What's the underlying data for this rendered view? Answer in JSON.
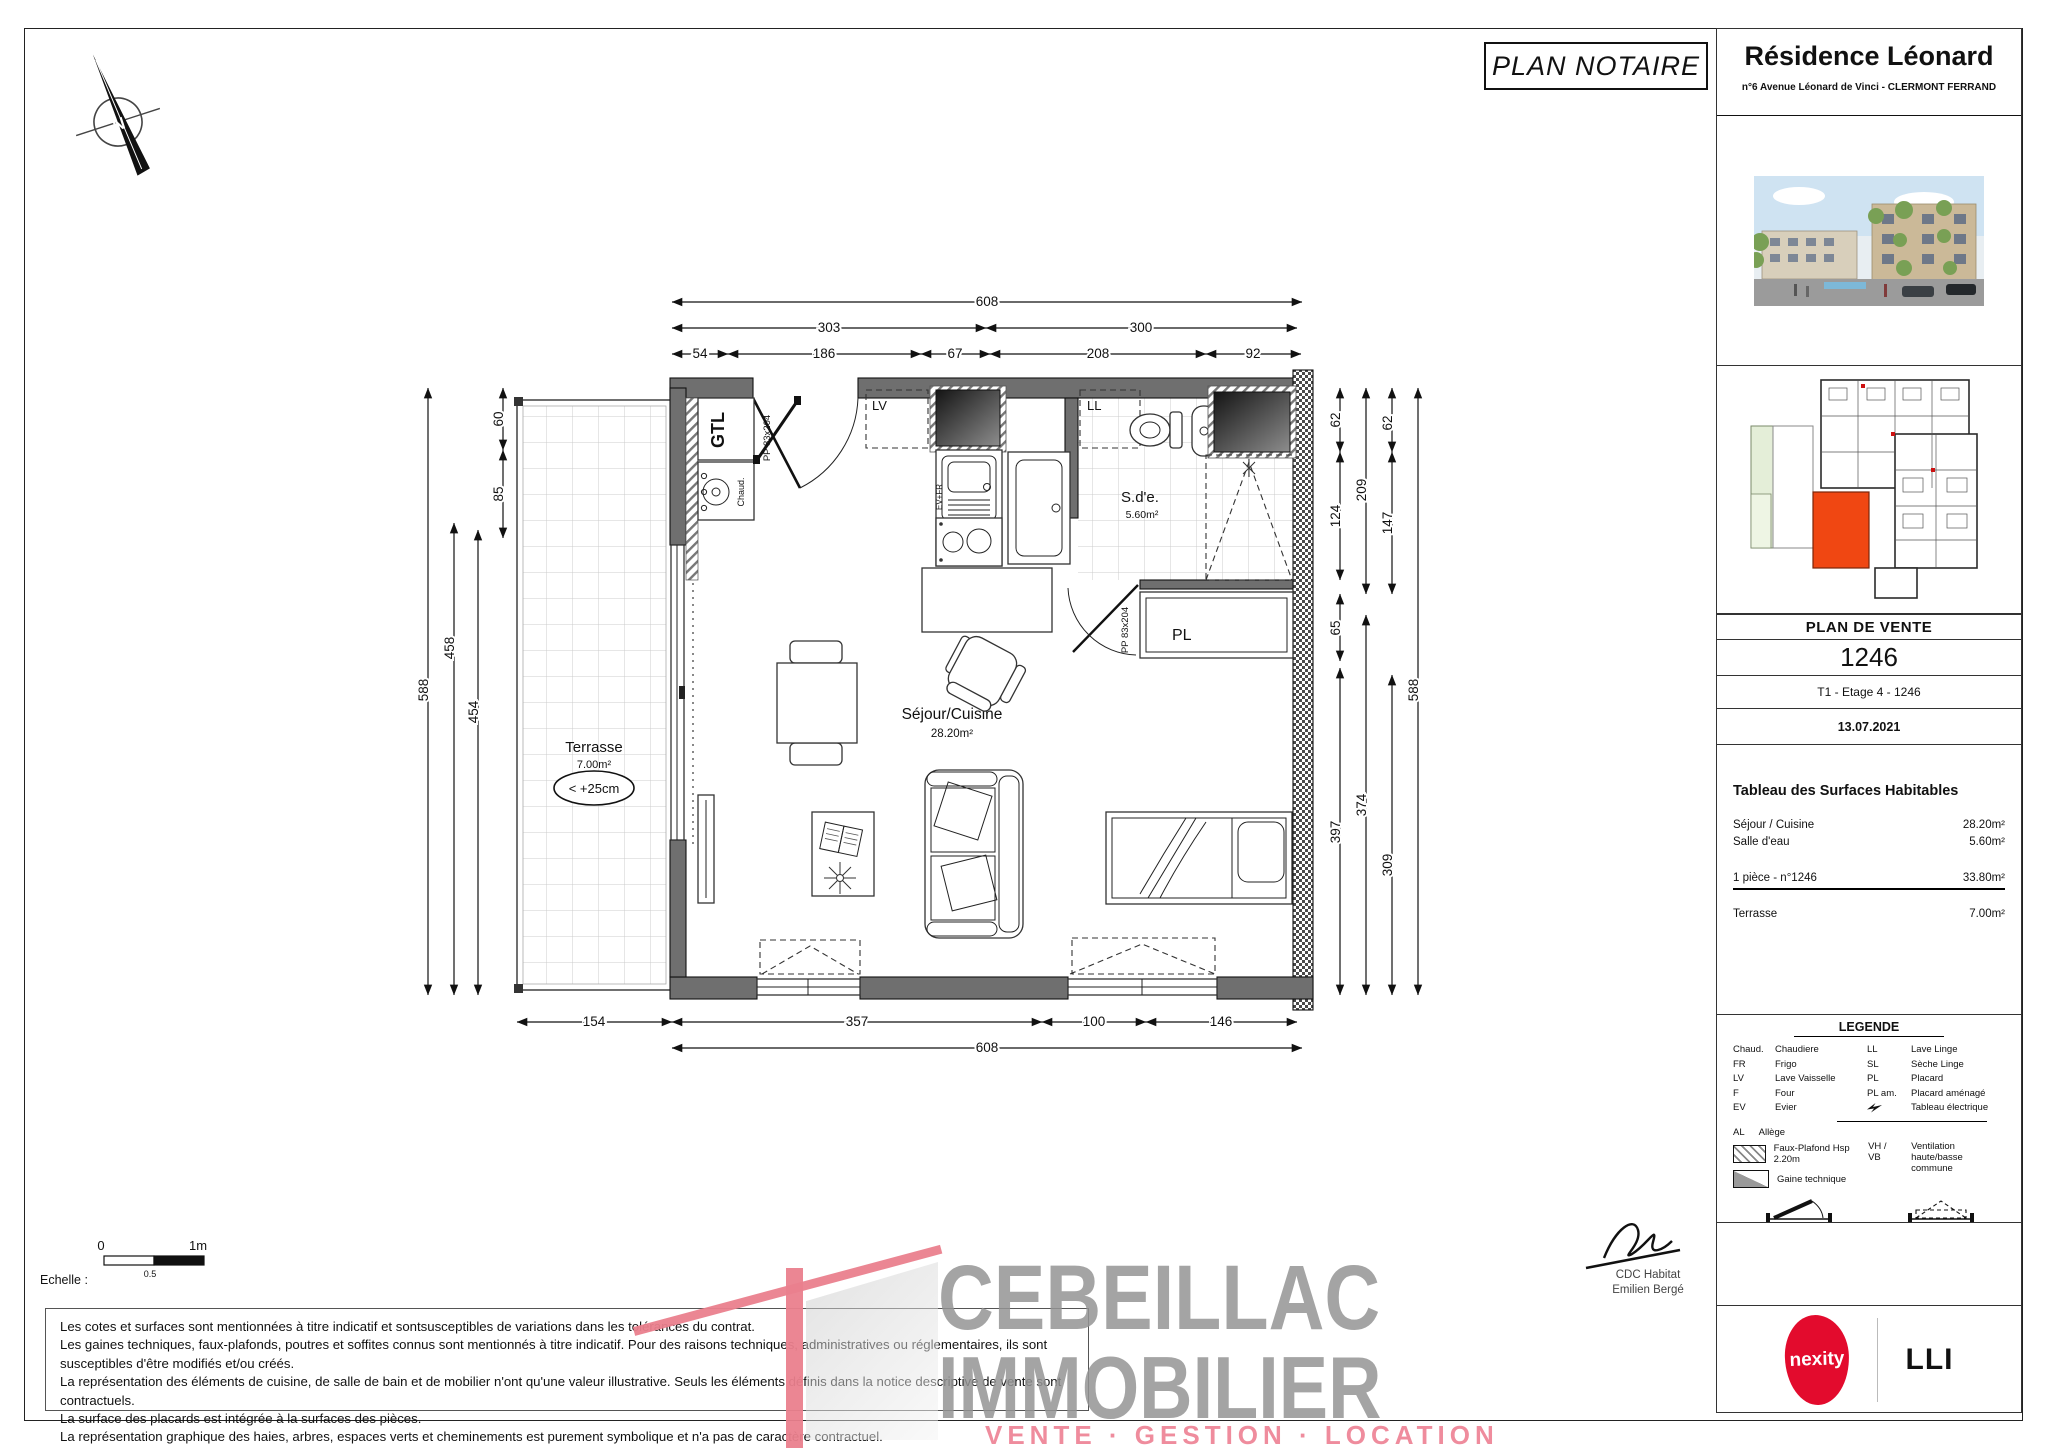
{
  "page": {
    "plan_notaire": "PLAN NOTAIRE",
    "echelle_label": "Echelle :",
    "scale_0": "0",
    "scale_05": "0.5",
    "scale_1m": "1m"
  },
  "header": {
    "title": "Résidence Léonard",
    "address": "n°6 Avenue Léonard de Vinci - CLERMONT FERRAND"
  },
  "sale": {
    "plan_de_vente": "PLAN DE VENTE",
    "lot_number": "1246",
    "lot_type": "T1 - Etage 4 - 1246",
    "date": "13.07.2021"
  },
  "surfaces": {
    "title": "Tableau des Surfaces Habitables",
    "rows": [
      {
        "label": "Séjour / Cuisine",
        "value": "28.20m²"
      },
      {
        "label": "Salle d'eau",
        "value": "5.60m²"
      }
    ],
    "total_label": "1 pièce - n°1246",
    "total_value": "33.80m²",
    "terrace_label": "Terrasse",
    "terrace_value": "7.00m²"
  },
  "legend": {
    "title": "LEGENDE",
    "col1": [
      {
        "abbr": "Chaud.",
        "label": "Chaudiere"
      },
      {
        "abbr": "FR",
        "label": "Frigo"
      },
      {
        "abbr": "LV",
        "label": "Lave Vaisselle"
      },
      {
        "abbr": "F",
        "label": "Four"
      },
      {
        "abbr": "EV",
        "label": "Evier"
      }
    ],
    "col2": [
      {
        "abbr": "LL",
        "label": "Lave Linge"
      },
      {
        "abbr": "SL",
        "label": "Sèche Linge"
      },
      {
        "abbr": "PL",
        "label": "Placard"
      },
      {
        "abbr": "PL am.",
        "label": "Placard aménagé"
      },
      {
        "abbr": "",
        "label": "Tableau électrique"
      }
    ],
    "al_abbr": "AL",
    "al_label": "Allège",
    "faux_plafond": "Faux-Plafond Hsp 2.20m",
    "gaine": "Gaine technique",
    "vh_abbr": "VH / VB",
    "vh_label1": "Ventilation",
    "vh_label2": "haute/basse commune",
    "pf_label": "PF = Porte Fenêtre",
    "f_label": "F = Fenêtre"
  },
  "signature": {
    "line1": "CDC Habitat",
    "line2": "Emilien Bergé"
  },
  "branding": {
    "nexity": "nexity",
    "lli": "LLI",
    "nexity_color": "#e30b2d",
    "unit_color": "#f04712"
  },
  "watermark": {
    "line1": "CEBEILLAC",
    "line2": "IMMOBILIER",
    "line3": "VENTE · GESTION · LOCATION"
  },
  "disclaimer": {
    "lines": [
      "Les cotes et surfaces sont mentionnées à titre indicatif et sontsusceptibles de variations dans les tolérances du contrat.",
      "Les gaines techniques, faux-plafonds, poutres et soffites connus sont mentionnés à titre indicatif. Pour des raisons techniques, administratives ou réglementaires, ils sont susceptibles d'être modifiés et/ou créés.",
      "La représentation des éléments de cuisine, de salle de bain et de mobilier n'ont qu'une valeur illustrative. Seuls les éléments définis dans la notice descriptive de vente sont contractuels.",
      "La surface des placards est intégrée à la surfaces des pièces.",
      "La représentation graphique des haies, arbres, espaces verts et cheminements est purement symbolique et n'a pas de caractère contractuel."
    ]
  },
  "plan": {
    "rooms": {
      "gtl": "GTL",
      "chaud": "Chaud.",
      "pp_entrance": "PP 83x204",
      "pp_bath": "PP 83x204",
      "lv": "LV",
      "ll": "LL",
      "evfr": "EV+FR",
      "sde": "S.d'e.",
      "sde_area": "5.60m²",
      "pl": "PL",
      "sejour": "Séjour/Cuisine",
      "sejour_area": "28.20m²",
      "terrasse": "Terrasse",
      "terrasse_area": "7.00m²",
      "terrasse_note": "< +25cm"
    },
    "dims": {
      "t608": "608",
      "t303": "303",
      "t300": "300",
      "t54": "54",
      "t186": "186",
      "t67": "67",
      "t208": "208",
      "t92": "92",
      "l588": "588",
      "l458": "458",
      "l454": "454",
      "l60": "60",
      "l85": "85",
      "r62a": "62",
      "r62b": "62",
      "r124": "124",
      "r209": "209",
      "r147": "147",
      "r65": "65",
      "r397": "397",
      "r374": "374",
      "r309": "309",
      "r588": "588",
      "b154": "154",
      "b357": "357",
      "b100": "100",
      "b146": "146",
      "b608": "608"
    }
  },
  "compass": {
    "n": "N"
  }
}
